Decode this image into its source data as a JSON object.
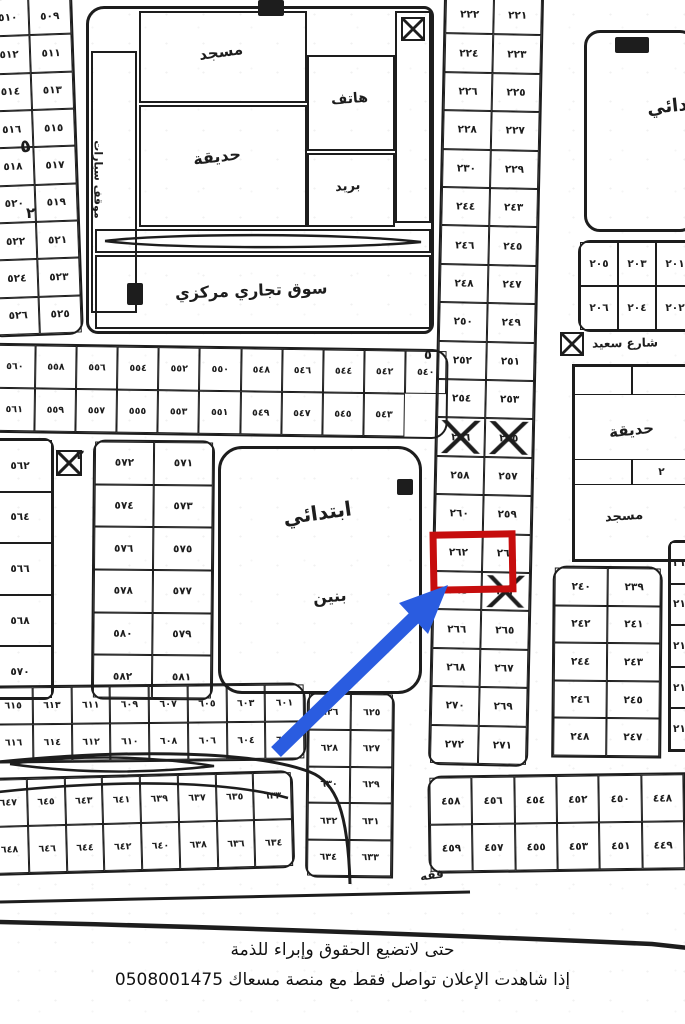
{
  "colors": {
    "ink": "#1d1d1d",
    "highlight_red": "#c60d0d",
    "arrow_blue": "#2a5ce0"
  },
  "caption": {
    "line1": "حتى لاتضيع الحقوق وإبراء للذمة",
    "line2": "إذا شاهدت الإعلان تواصل فقط مع منصة مسعاك 0508001475"
  },
  "map": {
    "highlighted_plot": "٢٦٢",
    "labels": {
      "mosque_nw": "مسجد",
      "phone": "هاتف",
      "garden_nw": "حديقة",
      "post": "بريد",
      "market": "سوق تجاري مركزي",
      "parking": "موقف سيارات",
      "school_line1": "ابتدائي",
      "school_line2": "بنين",
      "school_ne": "ابتدائي",
      "garden_e": "حديقة",
      "mosque_e": "مسجد",
      "street_e": "شارع سعيد",
      "bottom_note": "فقه",
      "cell_mark": "٢"
    },
    "road_marks": {
      "m1": "٥",
      "m2": "٢",
      "m3": "٥",
      "m4": "٢"
    },
    "strips": {
      "nw_left": [
        "٥١٠",
        "٥٠٩",
        "٥١٢",
        "٥١١",
        "٥١٤",
        "٥١٣",
        "٥١٦",
        "٥١٥",
        "٥١٨",
        "٥١٧",
        "٥٢٠",
        "٥١٩",
        "٥٢٢",
        "٥٢١",
        "٥٢٤",
        "٥٢٣",
        "٥٢٦",
        "٥٢٥"
      ],
      "mid": [
        "٥٦٠",
        "٥٥٨",
        "٥٥٦",
        "٥٥٤",
        "٥٥٢",
        "٥٥٠",
        "٥٤٨",
        "٥٤٦",
        "٥٤٤",
        "٥٤٢",
        "٥٤٠",
        "٥٦١",
        "٥٥٩",
        "٥٥٧",
        "٥٥٥",
        "٥٥٣",
        "٥٥١",
        "٥٤٩",
        "٥٤٧",
        "٥٤٥",
        "٥٤٣"
      ],
      "farleft_mid": [
        "٥٦٢",
        "٥٦٤",
        "٥٦٦",
        "٥٦٨",
        "٥٧٠"
      ],
      "leftcenter": [
        "٥٧٢",
        "٥٧١",
        "٥٧٤",
        "٥٧٣",
        "٥٧٦",
        "٥٧٥",
        "٥٧٨",
        "٥٧٧",
        "٥٨٠",
        "٥٧٩",
        "٥٨٢",
        "٥٨١"
      ],
      "center_col": [
        "٢٢٢",
        "٢٢١",
        "٢٢٤",
        "٢٢٣",
        "٢٢٦",
        "٢٢٥",
        "٢٢٨",
        "٢٢٧",
        "٢٣٠",
        "٢٢٩",
        "٢٤٤",
        "٢٤٣",
        "٢٤٦",
        "٢٤٥",
        "٢٤٨",
        "٢٤٧",
        "٢٥٠",
        "٢٤٩",
        "٢٥٢",
        "٢٥١",
        "٢٥٤",
        "٢٥٣",
        {
          "v": "٢٥٦",
          "cls": "xmark"
        },
        {
          "v": "٢٥٥",
          "cls": "xmark"
        },
        "٢٥٨",
        "٢٥٧",
        "٢٦٠",
        "٢٥٩",
        "٢٦٢",
        "٢٦١",
        "٢٦٤",
        {
          "v": "٢٦٣",
          "cls": "xmark"
        },
        "٢٦٦",
        "٢٦٥",
        "٢٦٨",
        "٢٦٧",
        "٢٧٠",
        "٢٦٩",
        "٢٧٢",
        "٢٧١"
      ],
      "ne_strip": [
        "٢٠٥",
        "٢٠٣",
        "٢٠١",
        "٢٠٦",
        "٢٠٤",
        "٢٠٢"
      ],
      "e_cells_a": [
        "",
        ""
      ],
      "e_cells_b": [
        "",
        "٢"
      ],
      "rc_block": [
        "٢٤٠",
        "٢٣٩",
        "٢٤٢",
        "٢٤١",
        "٢٤٤",
        "٢٤٣",
        "٢٤٦",
        "٢٤٥",
        "٢٤٨",
        "٢٤٧"
      ],
      "fr_sliver": [
        "٢١٩",
        "٢١٧",
        "٢١٥",
        "٢١٣",
        "٢١١"
      ],
      "bl_strip1": [
        "٦١٥",
        "٦١٣",
        "٦١١",
        "٦٠٩",
        "٦٠٧",
        "٦٠٥",
        "٦٠٣",
        "٦٠١",
        "٦١٦",
        "٦١٤",
        "٦١٢",
        "٦١٠",
        "٦٠٨",
        "٦٠٦",
        "٦٠٤",
        "٦٠٢"
      ],
      "bl_col": [
        "٦٢٦",
        "٦٢٥",
        "٦٢٨",
        "٦٢٧",
        "٦٣٠",
        "٦٢٩",
        "٦٣٢",
        "٦٣١",
        "٦٣٤",
        "٦٣٣"
      ],
      "bl_strip2": [
        "٦٤٧",
        "٦٤٥",
        "٦٤٣",
        "٦٤١",
        "٦٣٩",
        "٦٣٧",
        "٦٣٥",
        "٦٣٣",
        "٦٤٨",
        "٦٤٦",
        "٦٤٤",
        "٦٤٢",
        "٦٤٠",
        "٦٣٨",
        "٦٣٦",
        "٦٣٤"
      ],
      "br_strip": [
        "٤٥٨",
        "٤٥٦",
        "٤٥٤",
        "٤٥٢",
        "٤٥٠",
        "٤٤٨",
        "٤٥٩",
        "٤٥٧",
        "٤٥٥",
        "٤٥٣",
        "٤٥١",
        "٤٤٩"
      ]
    }
  }
}
